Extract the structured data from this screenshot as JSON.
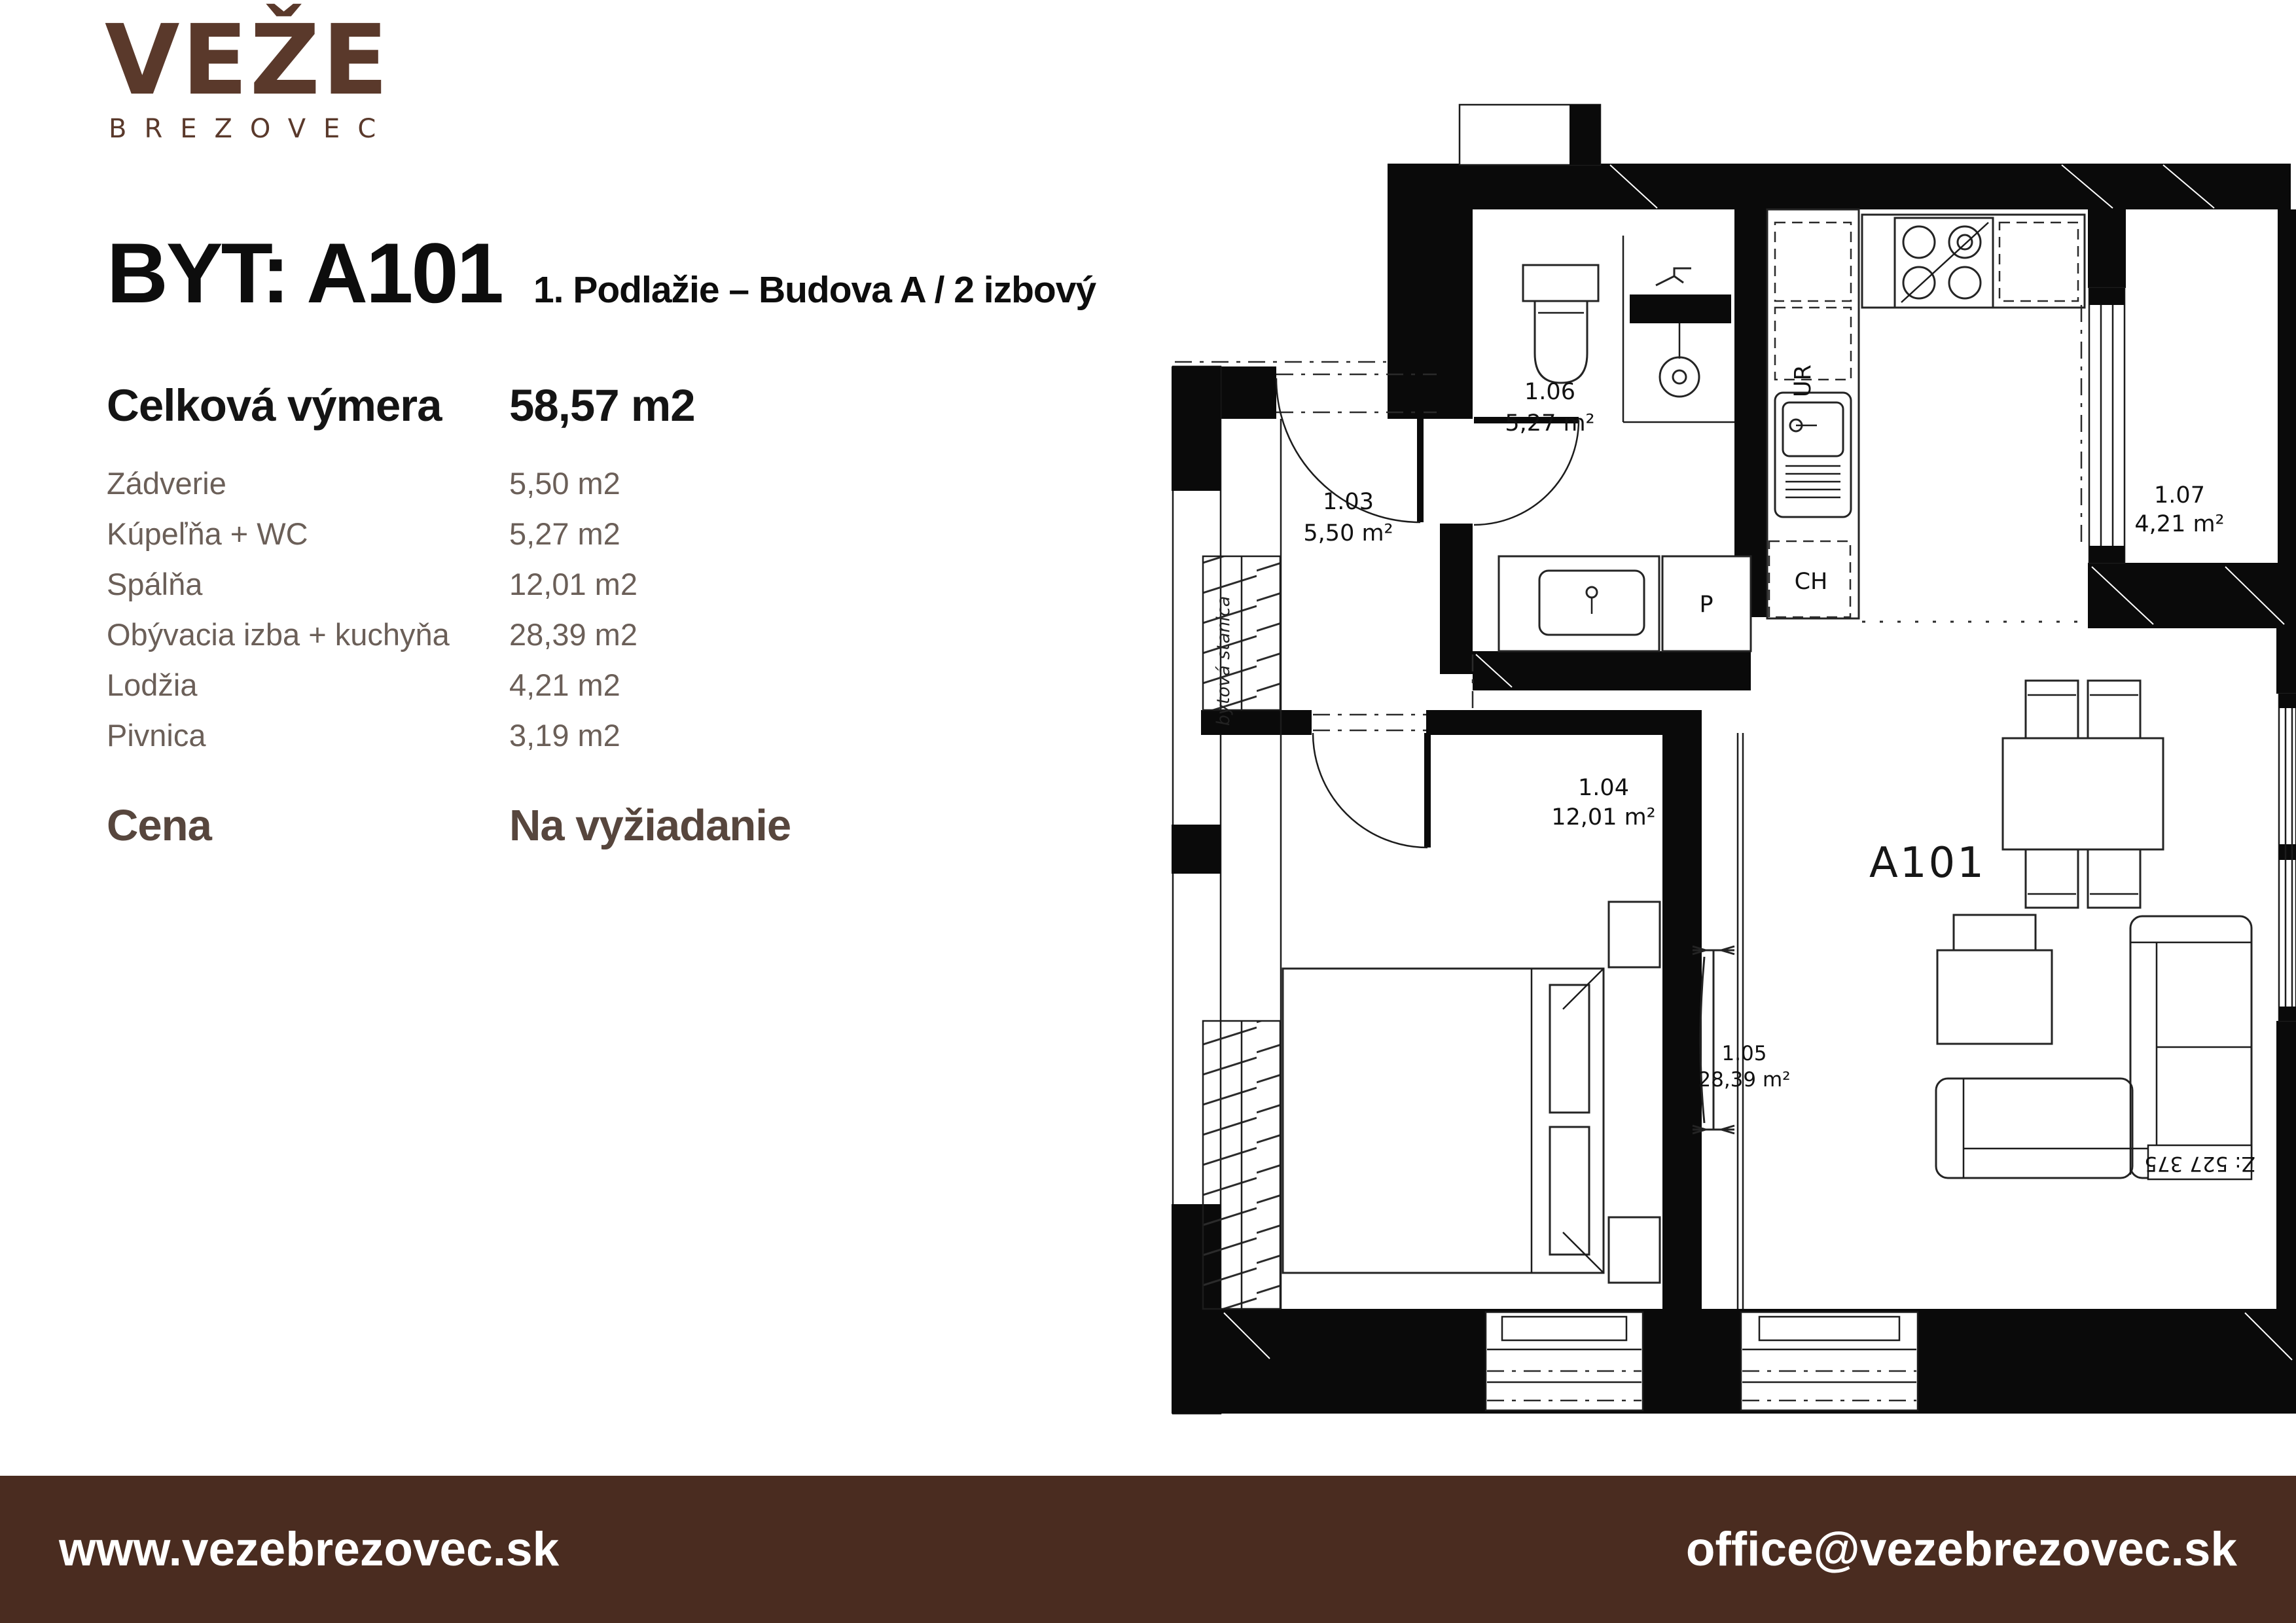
{
  "logo": {
    "name": "VEŽE",
    "subname": "BREZOVEC"
  },
  "header": {
    "title": "BYT: A101",
    "subtitle": "1. Podlažie – Budova A / 2 izbový"
  },
  "summary": {
    "total_label": "Celková výmera",
    "total_value": "58,57 m2",
    "rows": [
      {
        "label": "Zádverie",
        "value": "5,50 m2"
      },
      {
        "label": "Kúpeľňa + WC",
        "value": "5,27 m2"
      },
      {
        "label": "Spálňa",
        "value": "12,01 m2"
      },
      {
        "label": "Obývacia izba + kuchyňa",
        "value": "28,39 m2"
      },
      {
        "label": "Lodžia",
        "value": "4,21 m2"
      },
      {
        "label": "Pivnica",
        "value": "3,19 m2"
      }
    ],
    "price_label": "Cena",
    "price_value": "Na vyžiadanie"
  },
  "floorplan": {
    "apartment_label": "A101",
    "rooms": {
      "hall": {
        "id": "1.03",
        "area": "5,50 m²"
      },
      "bedroom": {
        "id": "1.04",
        "area": "12,01 m²"
      },
      "living": {
        "id": "1.05",
        "area": "28,39 m²"
      },
      "bathroom": {
        "id": "1.06",
        "area": "5,27 m²"
      },
      "loggia": {
        "id": "1.07",
        "area": "4,21 m²"
      }
    },
    "labels": {
      "washer": "P",
      "fridge": "CH",
      "sink_unit": "UR",
      "tech_room": "bytová stanica",
      "drawing_no": "Z: 527 375"
    }
  },
  "footer": {
    "website": "www.vezebrezovec.sk",
    "email": "office@vezebrezovec.sk"
  },
  "colors": {
    "brand_brown": "#5a392b",
    "footer_background": "#4a2c20",
    "muted_text": "#6b5f58",
    "price_text": "#57463d",
    "ink": "#0d0d0d"
  }
}
